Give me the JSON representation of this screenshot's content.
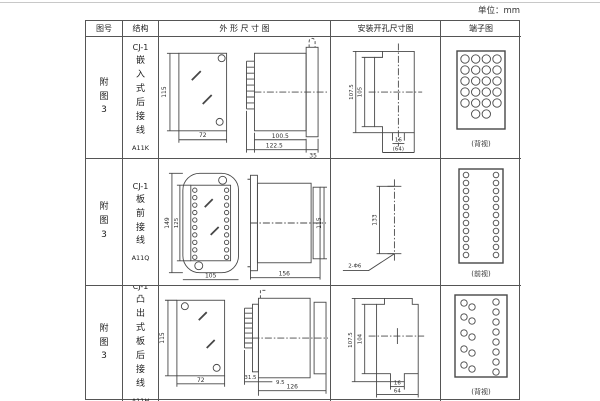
{
  "page": {
    "unit_label": "单位：mm"
  },
  "table": {
    "headers": {
      "figure_no": "图号",
      "structure": "结构",
      "outline": "外 形 尺 寸 图",
      "install": "安装开孔尺寸图",
      "terminal": "端子图"
    },
    "rows": [
      {
        "figure_no": "附图3",
        "series": "CJ-1",
        "structure": "嵌入式后接线",
        "model": "A11K",
        "dims": {
          "front_h": "115",
          "front_w": "72",
          "body_len": "100.5",
          "total_len": "122.5",
          "flange": "35"
        },
        "install": {
          "outer_h": "107.5",
          "inner_h": "105",
          "slot_w": "16",
          "width": "(64)"
        },
        "terminal": {
          "view": "(背视)"
        }
      },
      {
        "figure_no": "附图3",
        "series": "CJ-1",
        "structure": "板前接线",
        "model": "A11Q",
        "dims": {
          "flange_h": "149",
          "inner_h": "125",
          "front_w": "105",
          "side_len": "156",
          "side_h": "115"
        },
        "install": {
          "pitch": "133",
          "holes": "2-Φ6"
        },
        "terminal": {
          "view": "(前视)"
        }
      },
      {
        "figure_no": "附图3",
        "series": "CJ-1",
        "structure": "凸出式板后接线",
        "model": "A11H",
        "dims": {
          "front_h": "115",
          "front_w": "72",
          "pin_len": "31.5",
          "offset": "9.5",
          "side_len": "126"
        },
        "install": {
          "outer_h": "107.5",
          "inner_h": "104",
          "slot_w": "16",
          "width": "64"
        },
        "terminal": {
          "view": "(背视)"
        }
      }
    ]
  }
}
